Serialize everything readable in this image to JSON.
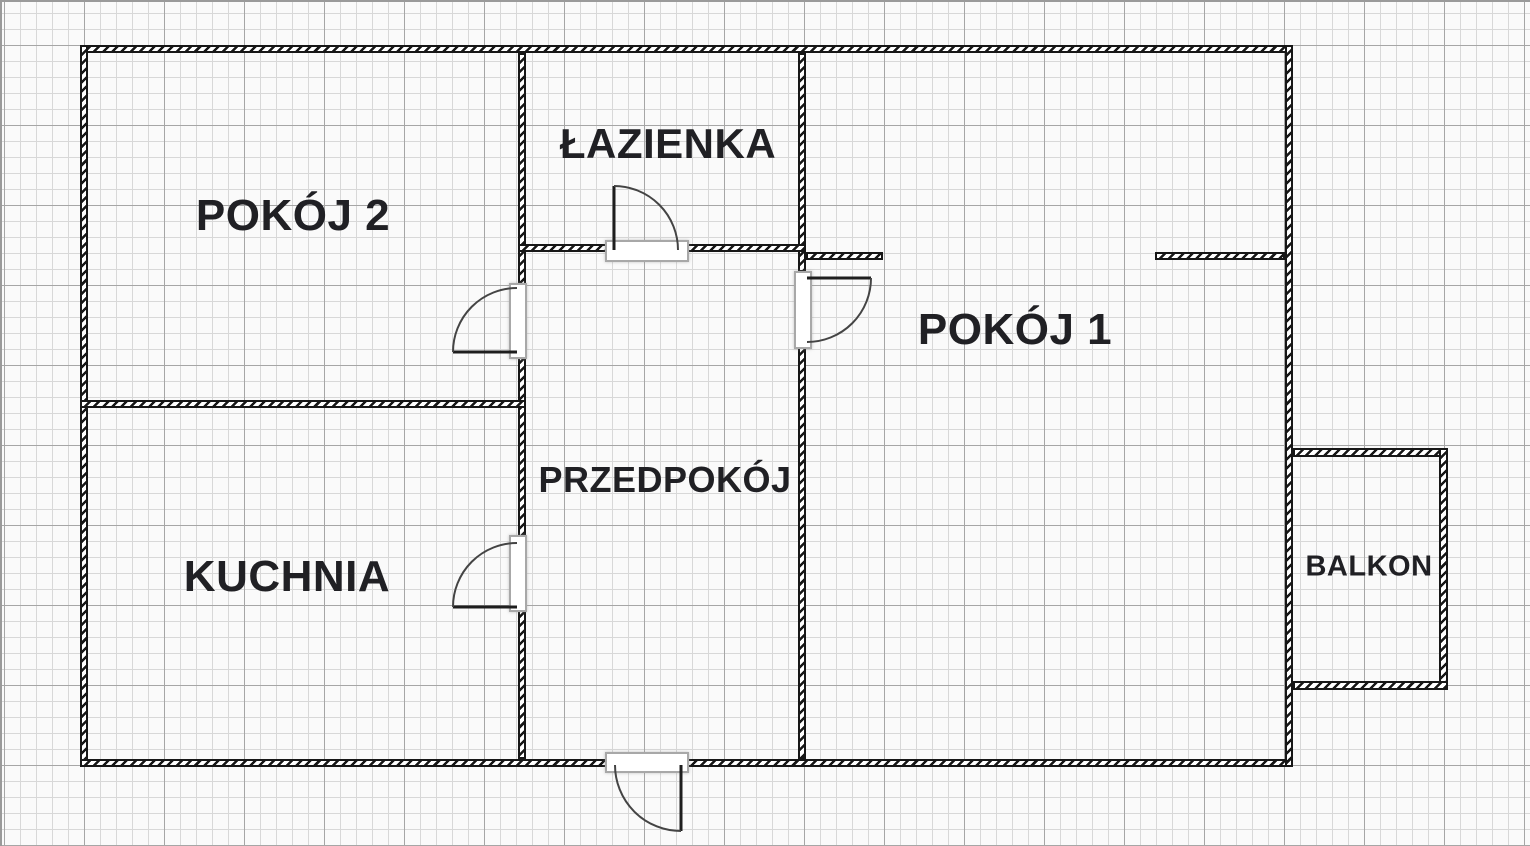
{
  "rooms": {
    "pokoj2": {
      "label": "POKÓJ 2"
    },
    "lazienka": {
      "label": "ŁAZIENKA"
    },
    "pokoj1": {
      "label": "POKÓJ 1"
    },
    "przedpokoj": {
      "label": "PRZEDPOKÓJ"
    },
    "kuchnia": {
      "label": "KUCHNIA"
    },
    "balkon": {
      "label": "BALKON"
    }
  },
  "colors": {
    "wall": "#171717",
    "text": "#202024",
    "grid_minor": "#d8d8d8",
    "grid_major": "#a6a6a6",
    "background": "#fafafa",
    "threshold_border": "#a8a8a8",
    "door_arc": "#444444"
  }
}
